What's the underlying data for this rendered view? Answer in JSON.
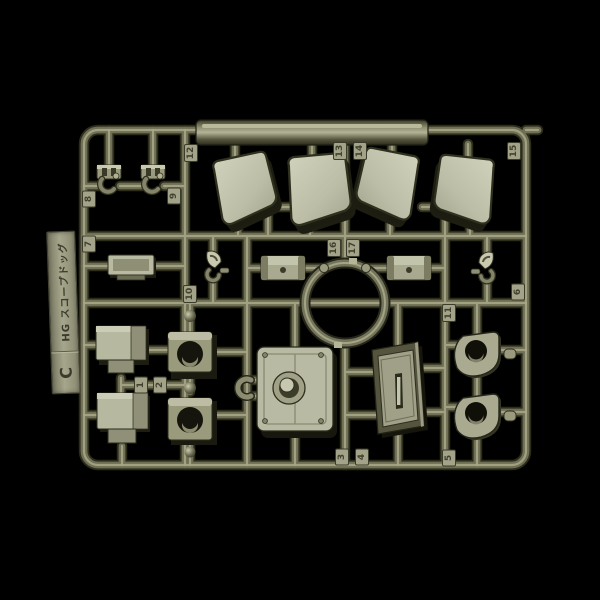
{
  "photo": {
    "background_color": "#000000",
    "subject": "olive-drab plastic model kit parts runner"
  },
  "label_tab": {
    "series": "HG スコープドッグ",
    "runner_letter": "C"
  },
  "part_tags": [
    "12",
    "13",
    "14",
    "15",
    "8",
    "9",
    "7",
    "10",
    "16",
    "17",
    "6",
    "11",
    "1",
    "2",
    "3",
    "4",
    "5"
  ],
  "colors": {
    "background": "#000000",
    "plastic_dark": "#2c2c1b",
    "plastic_mid": "#6f6f56",
    "plastic_highlight": "#a6a687",
    "part_face_light": "#c0c1aa",
    "label_tab": "#9c9c84",
    "tag_background": "#a3a389",
    "embossed_text": "#42422f"
  },
  "parts": [
    {
      "name": "hand-clamp",
      "count": 2
    },
    {
      "name": "armor-plate",
      "count": 4
    },
    {
      "name": "equipment-tray",
      "count": 1
    },
    {
      "name": "small-joint-figure",
      "count": 2
    },
    {
      "name": "forearm-bracket",
      "count": 2
    },
    {
      "name": "scope-ring",
      "count": 1
    },
    {
      "name": "ankle-armor-box",
      "count": 2
    },
    {
      "name": "ball-joint-block",
      "count": 2
    },
    {
      "name": "cockpit-hatch",
      "count": 1
    },
    {
      "name": "pipe-clamp",
      "count": 1
    },
    {
      "name": "side-door",
      "count": 1
    },
    {
      "name": "dome-cover",
      "count": 2
    }
  ]
}
